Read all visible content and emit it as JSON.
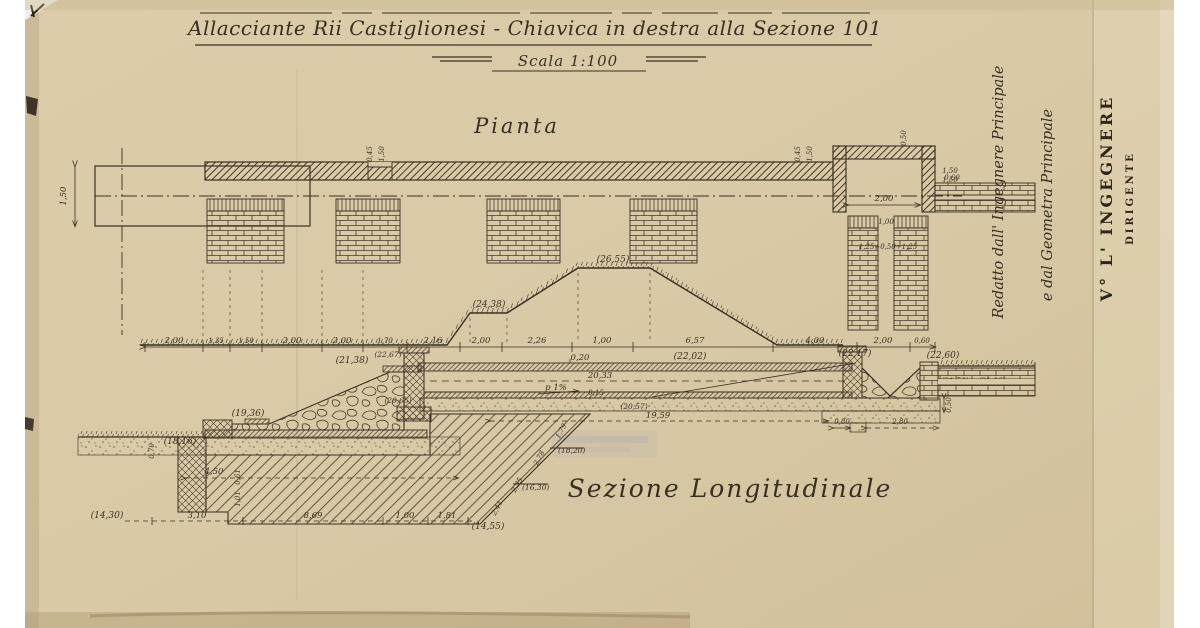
{
  "colors": {
    "paper": "#d9c9a7",
    "ink": "#3a3020"
  },
  "title": {
    "main": "Allacciante Rii Castiglionesi - Chiavica in destra alla Sezione 101",
    "scale": "Scala 1:100"
  },
  "side_panel": {
    "note1": "Redatto dall' Ingegnere Principale",
    "note2": "e dal Geometra Principale",
    "stamp_line1": "V° L' INGEGNERE",
    "stamp_line2": "DIRIGENTE"
  },
  "plan": {
    "label": "Pianta",
    "dim_left_height": "1,50",
    "step_a1": "0,45",
    "step_a2": "1,50",
    "step_b1": "0,45",
    "step_b2": "1,50",
    "dim_top_small": "0,50",
    "dim_chamber_width": "2,00",
    "dim_right1": "1,50",
    "dim_right2": "1,50",
    "dim_channel": "0,60",
    "dim_pier_gap": "1,00",
    "dim_piers": "1,25÷0,50÷1,25"
  },
  "section": {
    "label": "Sezione Longitudinale",
    "chain": [
      "2,00",
      "1,35",
      "1,50",
      "2,00",
      "2,00",
      "1,70",
      "2,16",
      "2,00",
      "2,26",
      "1,00",
      "6,57",
      "4,00",
      "2,00",
      "0,60"
    ],
    "elev": {
      "top": "(26,55)",
      "berm": "(24,38)",
      "stone_top": "(21,38)",
      "stone_berm": "(19,36)",
      "ground_left": "(18,16)",
      "headwall": "(22,67)",
      "slab": "(22,02)",
      "outlet": "(22,17)",
      "bank": "(22,60)",
      "channel_a": "(21,50)",
      "channel_b": "(21,00)",
      "floor": "(20,57)",
      "inlet": "(20,65)",
      "step1": "(18,20)",
      "step2": "(16,30)",
      "found_bottom": "(14,55)",
      "bottom_left": "(14,30)"
    },
    "dims": {
      "slab_thk": "0,20",
      "interior_len": "20,33",
      "slope": "p 1%",
      "floor_thk": "0,15",
      "floor_len": "19,59",
      "gap": "0,80",
      "basin": "2,80",
      "basin_depth": "0,50",
      "found_w": "4,50",
      "bottom1": "3,10",
      "bottom2": "8,69",
      "bottom3": "1,00",
      "bottom4": "1,81",
      "slant1": "1,79",
      "slant2": "2,78",
      "slant3": "2,35",
      "slant4": "2,41",
      "v1": "0,61",
      "v2": "1,01",
      "left_v": "0,70"
    }
  }
}
